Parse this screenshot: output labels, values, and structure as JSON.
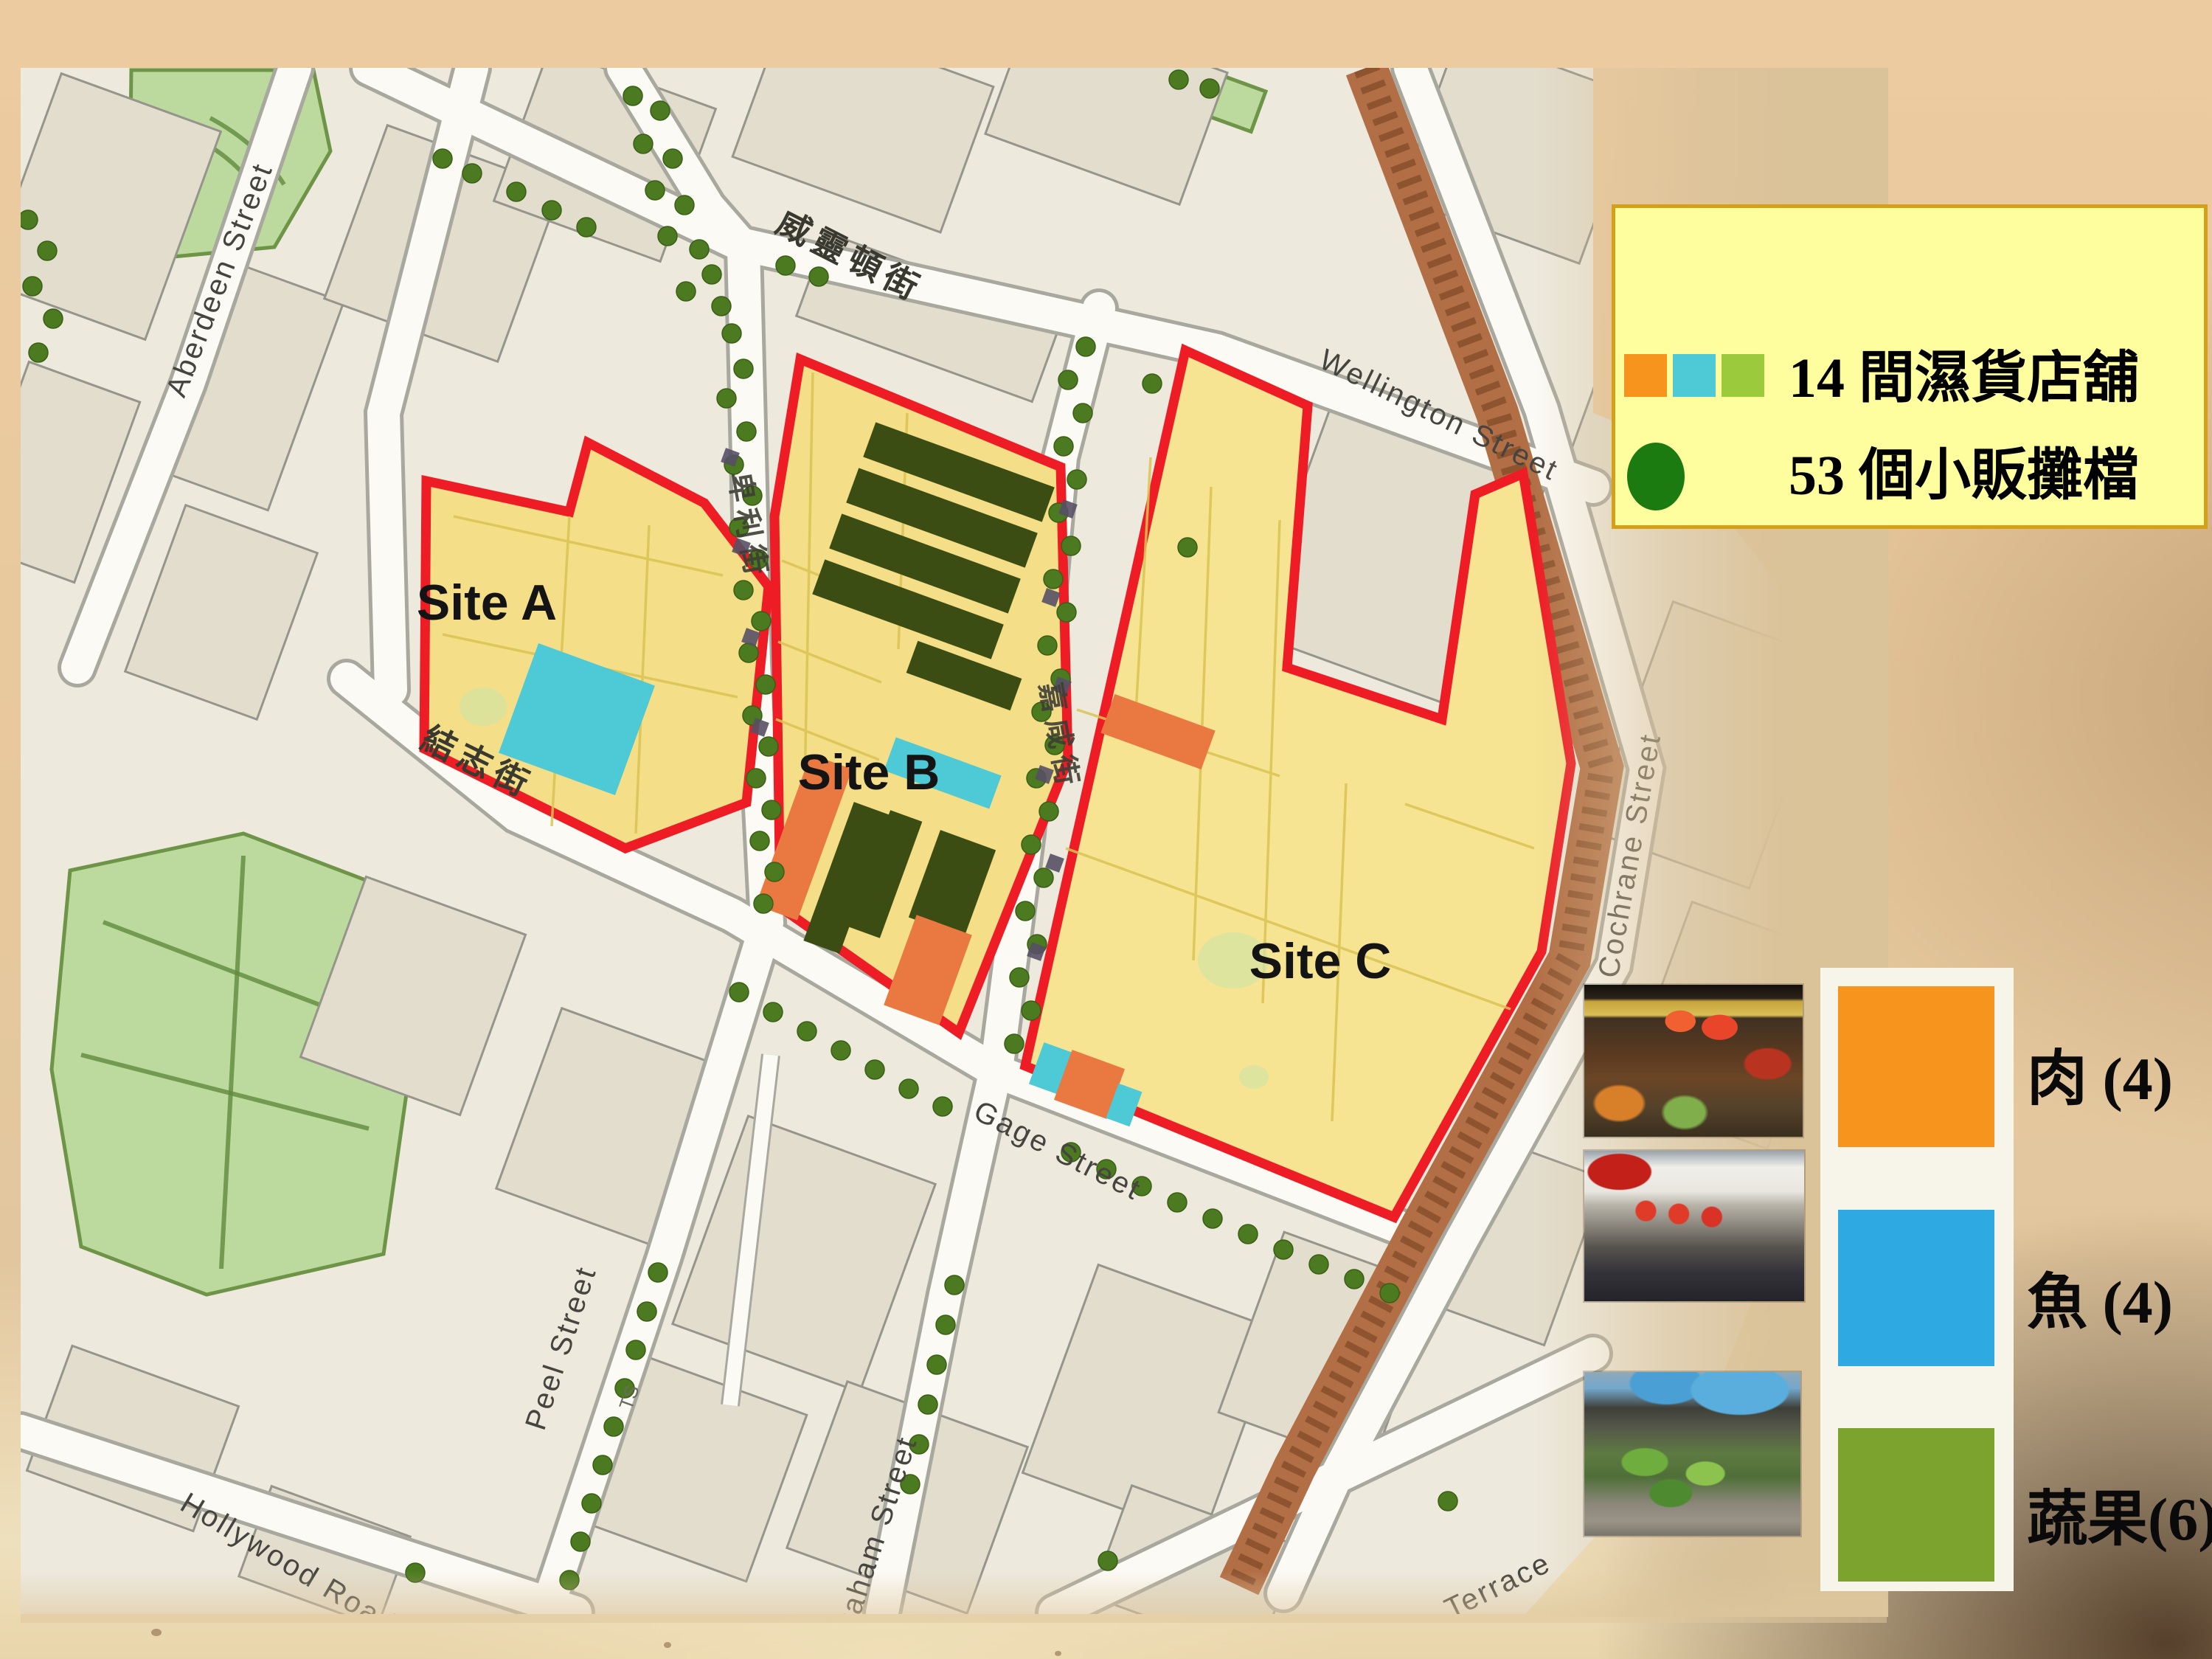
{
  "map": {
    "labels": {
      "aberdeen": "Aberdeen Street",
      "wellington_zh": "威靈頓街",
      "wellington_en": "Wellington Street",
      "gage_zh": "結志街",
      "gage_en": "Gage Street",
      "peel_zh": "卑利街",
      "peel_en": "Peel Street",
      "graham_zh": "嘉咸街",
      "graham_en": "Graham Street",
      "cochrane": "Cochrane Street",
      "hollywood": "Hollywood Road",
      "terrace": "Terrace",
      "lyndhurst_zh": "擺花街",
      "ts": "TS",
      "site_a": "Site A",
      "site_b": "Site B",
      "site_c": "Site C"
    }
  },
  "top_legend": {
    "line1": "14 間濕貨店舖",
    "line2": "53 個小販攤檔"
  },
  "side_legend": {
    "items": [
      {
        "label": "肉 (4)"
      },
      {
        "label": "魚 (4)"
      },
      {
        "label": "蔬果(6)"
      }
    ]
  },
  "colors": {
    "site_fill": "#F5DE88",
    "site_fill_c": "#F6E492",
    "outline_red": "#EE1C25",
    "map_orange": "#E97841",
    "map_cyan": "#4EC9D6",
    "map_olive": "#3C4D13",
    "legend_orange": "#F7941E",
    "legend_blue": "#2FA9E1",
    "legend_green": "#7CA32E",
    "legend_chip_green": "#9BCB3C",
    "stall_dot": "#4C7A20",
    "hawker_circle": "#1B7B10",
    "escalator_brown": "#B26F46",
    "park_green": "#BCDA9E",
    "legend_bg": "#FEFE9E"
  }
}
